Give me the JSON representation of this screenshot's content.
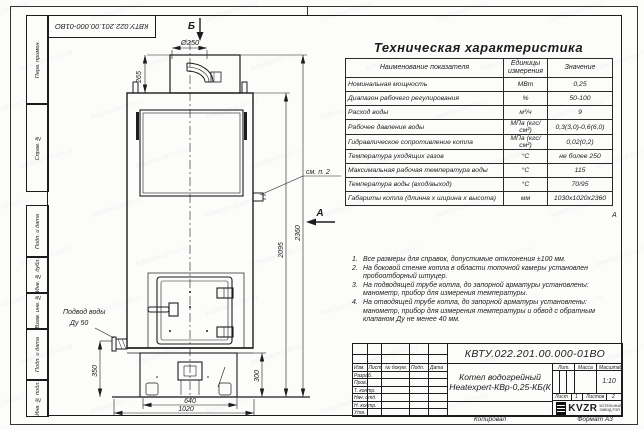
{
  "sheet": {
    "stamp_top": "КВТУ.022.201.00.000-01ВО",
    "zone_marker": "А",
    "side_labels": [
      {
        "label": "Перв. примен."
      },
      {
        "label": "Справ. №"
      },
      {
        "label": "Подп. и дата"
      },
      {
        "label": "Инв. № дубл."
      },
      {
        "label": "Взам. инв. №"
      },
      {
        "label": "Подп. и дата"
      },
      {
        "label": "Инв. № подл."
      }
    ],
    "watermark_text": "kotelzavod-rzn.ru"
  },
  "drawing": {
    "marker_top": "Б",
    "marker_side": "А",
    "callout_note": "см. п. 2",
    "water_label_line1": "Подвод воды",
    "water_label_line2": "Ду 50",
    "dims": {
      "chimney_diameter": "Ø250",
      "chimney_height": "265",
      "total_height": "2360",
      "body_height": "2095",
      "inlet_height": "350",
      "base_height": "300",
      "base_width": "640",
      "overall_width": "1020"
    }
  },
  "spec": {
    "title": "Техническая характеристика",
    "col_name": "Наименование показателя",
    "col_unit": "Единицы измерения",
    "col_value": "Значение",
    "rows": [
      {
        "name": "Номинальная мощность",
        "unit": "МВт",
        "value": "0,25"
      },
      {
        "name": "Диапазон рабочего регулирования",
        "unit": "%",
        "value": "50-100"
      },
      {
        "name": "Расход воды",
        "unit": "м³/ч",
        "value": "9"
      },
      {
        "name": "Рабочее давление воды",
        "unit": "МПа (кгс/см²)",
        "value": "0,3(3,0)-0,6(6,0)"
      },
      {
        "name": "Гидравлическое сопротивление котла",
        "unit": "МПа (кгс/см²)",
        "value": "0,02(0,2)"
      },
      {
        "name": "Температура уходящих газов",
        "unit": "°С",
        "value": "не более 250"
      },
      {
        "name": "Максимальная рабочая температура воды",
        "unit": "°С",
        "value": "115"
      },
      {
        "name": "Температура воды (вход/выход)",
        "unit": "°С",
        "value": "70/95"
      },
      {
        "name": "Габариты котла (длинна х ширина х высота)",
        "unit": "мм",
        "value": "1030х1020х2360"
      }
    ]
  },
  "notes": [
    {
      "num": "1.",
      "text": "Все размеры для справок, допустимые отклонения ±100 мм."
    },
    {
      "num": "2.",
      "text": "На боковой стенке котла в области топочной камеры установлен пробоотборный штуцер."
    },
    {
      "num": "3.",
      "text": "На подводящей трубе котла, до запорной арматуры установлены: манометр, прибор для измерения температуры."
    },
    {
      "num": "4.",
      "text": "На отводящей трубе котла, до запорной арматуры установлены: манометр, прибор для измерения температуры и обвод с обратным клапаном Ду не менее 40 мм."
    }
  ],
  "title_block": {
    "doc_number": "КВТУ.022.201.00.000-01ВО",
    "product_name_line1": "Котел водогрейный",
    "product_name_line2": "Heatexpert-КВр-0,25-КБ(К",
    "rev_headers": [
      {
        "label": "Изм."
      },
      {
        "label": "Лист"
      },
      {
        "label": "№ докум."
      },
      {
        "label": "Подп."
      },
      {
        "label": "Дата"
      }
    ],
    "sig_rows": [
      {
        "label": "Разраб."
      },
      {
        "label": "Пров."
      },
      {
        "label": "Т. контр."
      },
      {
        "label": "Нач. отд."
      },
      {
        "label": "Н. контр."
      },
      {
        "label": "Утв."
      }
    ],
    "lit_header": "Лит.",
    "mass_header": "Масса",
    "scale_header": "Масштаб",
    "scale_value": "1:10",
    "sheet_label": "Лист",
    "sheet_value": "1",
    "sheets_label": "Листов",
    "sheets_value": "2",
    "logo_word": "KVZR",
    "logo_caption_line1": "КОТЕЛЬНЫЙ",
    "logo_caption_line2": "ЗАВОД РЭП",
    "footer_copy": "Копировал",
    "footer_format": "Формат А3"
  }
}
